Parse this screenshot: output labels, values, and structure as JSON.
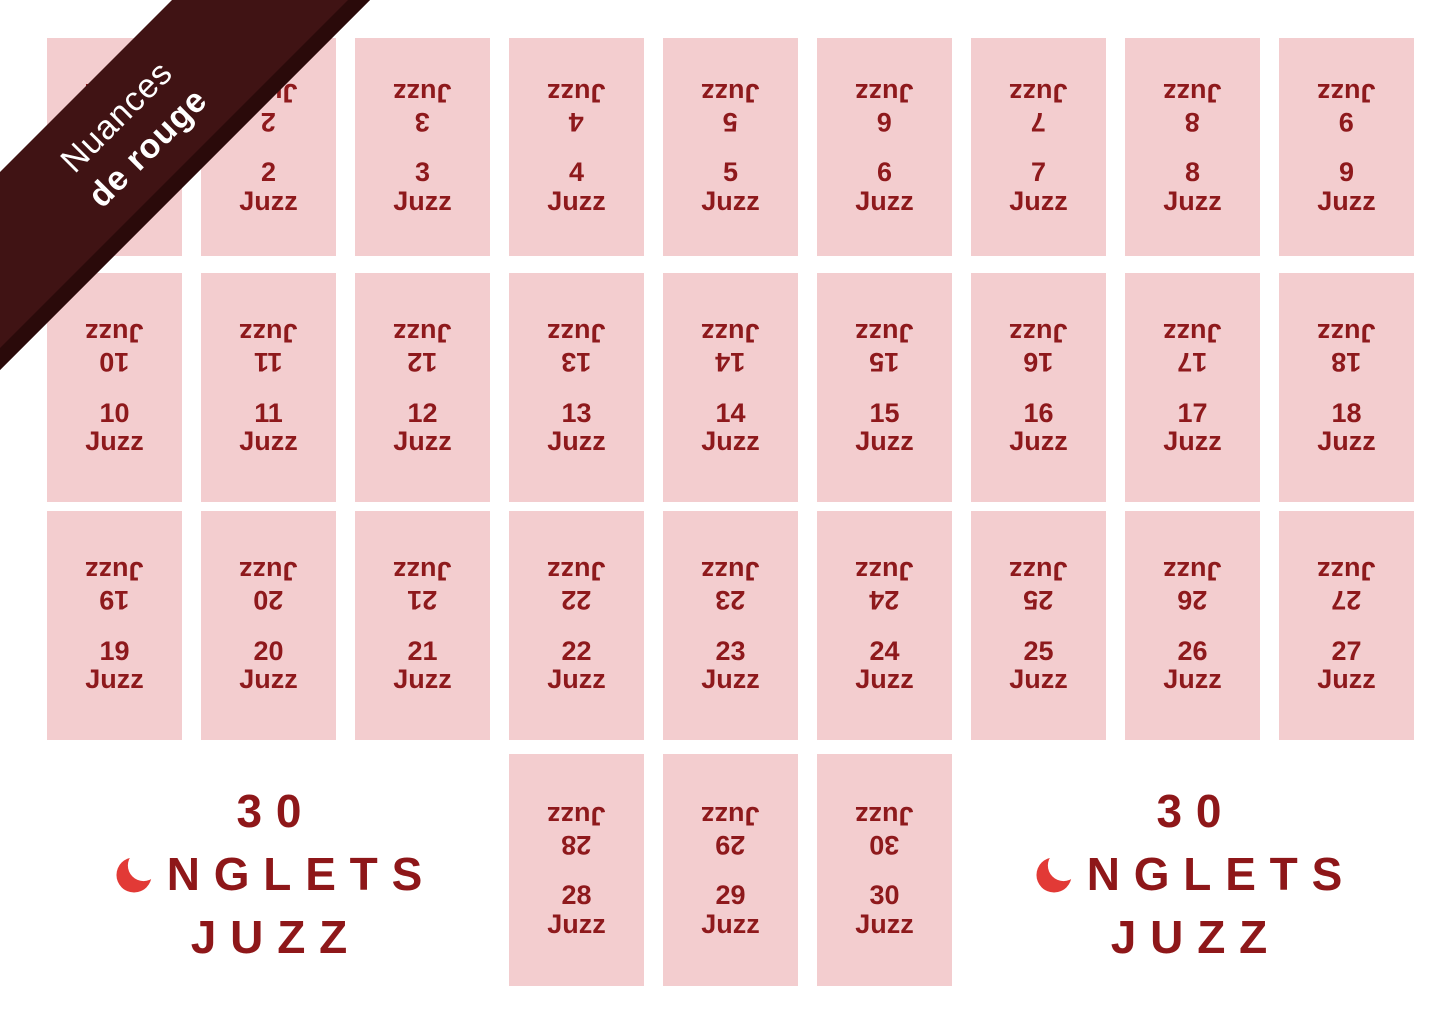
{
  "page": {
    "background": "#FFFFFF"
  },
  "ribbon": {
    "line1": "Nuances",
    "line2": "de rouge",
    "bg_color": "#401314",
    "edge_color": "#2A0A0A",
    "text_color": "#FFFFFF"
  },
  "grid": {
    "card_label": "Juzz",
    "card_bg": "#F3CDCF",
    "card_text_color": "#8E191C",
    "rows": [
      {
        "numbers": [
          1,
          2,
          3,
          4,
          5,
          6,
          7,
          8,
          9
        ]
      },
      {
        "numbers": [
          10,
          11,
          12,
          13,
          14,
          15,
          16,
          17,
          18
        ]
      },
      {
        "numbers": [
          19,
          20,
          21,
          22,
          23,
          24,
          25,
          26,
          27
        ]
      },
      {
        "numbers": [
          28,
          29,
          30
        ]
      }
    ]
  },
  "logo": {
    "count": "30",
    "name_rest": "NGLETS",
    "word": "JUZZ",
    "icon": "crescent-moon-icon",
    "text_color": "#8E1719",
    "crescent_color": "#E23A36"
  }
}
